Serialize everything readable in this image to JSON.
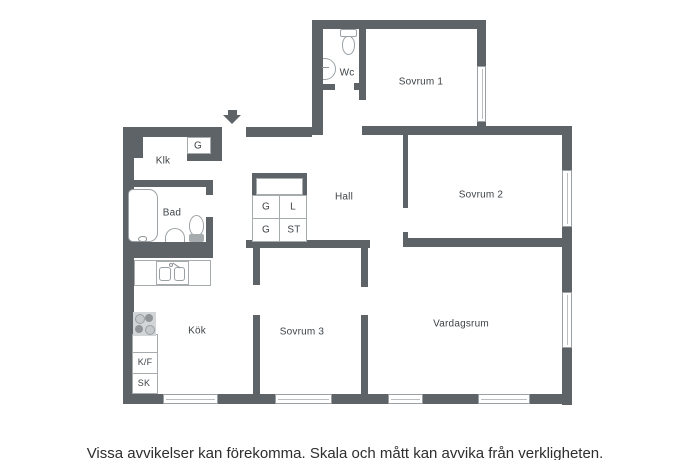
{
  "plan": {
    "room_labels": {
      "wc": "Wc",
      "sovrum1": "Sovrum 1",
      "klk": "Klk",
      "hall": "Hall",
      "sovrum2": "Sovrum 2",
      "bad": "Bad",
      "kok": "Kök",
      "sovrum3": "Sovrum 3",
      "vardagsrum": "Vardagsrum"
    },
    "closet_labels": {
      "entry_g": "G",
      "g1": "G",
      "l": "L",
      "g2": "G",
      "st": "ST",
      "kf": "K/F",
      "sk": "SK"
    }
  },
  "disclaimer": "Vissa avvikelser kan förekomma. Skala och mått kan avvika från verkligheten.",
  "colors": {
    "wall": "#5e6367",
    "thin_line": "#a6abae",
    "text": "#3e4347",
    "background": "#ffffff"
  }
}
